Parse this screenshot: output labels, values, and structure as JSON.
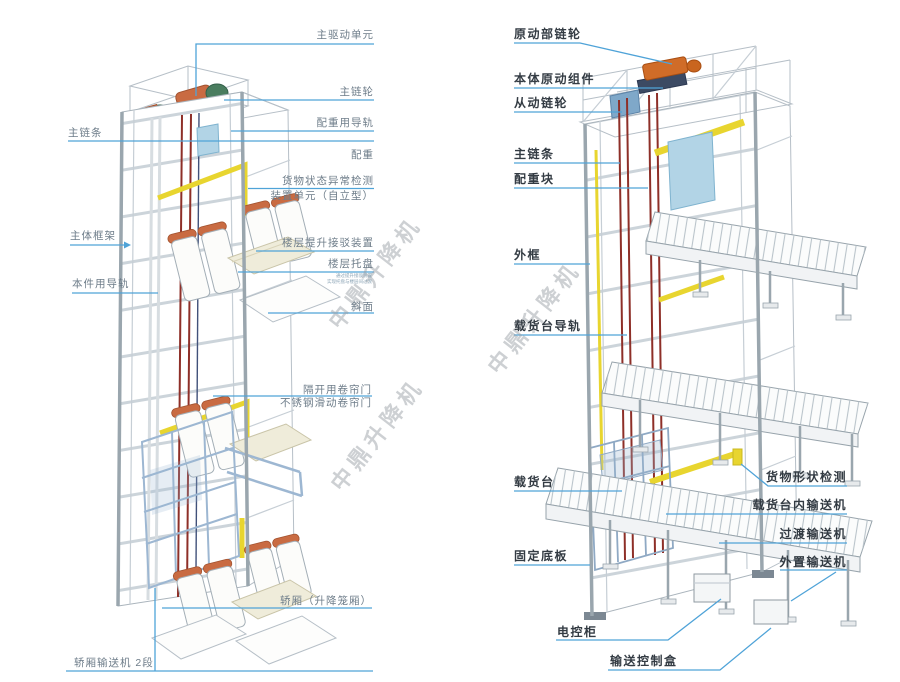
{
  "watermark": {
    "text": "中鼎升降机"
  },
  "left": {
    "labels": {
      "main_drive": "主驱动单元",
      "main_sprocket": "主链轮",
      "cw_guide_rail": "配重用导轨",
      "counterweight": "配重",
      "detect_line1": "货物状态异常检测",
      "detect_line2": "装置单元（自立型）",
      "main_chain": "主链条",
      "main_frame": "主体框架",
      "unit_guide_rail": "本件用导轨",
      "floor_docking": "楼层提升接驳装置",
      "floor_tray": "楼层托盘",
      "tray_note1": "通过提升接驳装置",
      "tray_note2": "实现托盘与楼层间过渡",
      "slope": "斜面",
      "roller_door": "隔开用卷帘门",
      "ss_door": "不锈钢滑动卷帘门",
      "cage": "轿厢（升降笼厢）",
      "cage_conveyor": "轿厢输送机 2段"
    }
  },
  "right": {
    "labels": {
      "drive_sprocket": "原动部链轮",
      "drive_assembly": "本体原动组件",
      "driven_sprocket": "从动链轮",
      "main_chain": "主链条",
      "cw_block": "配重块",
      "outer_frame": "外框",
      "platform_rail": "载货台导轨",
      "platform": "载货台",
      "base_plate": "固定底板",
      "control_cabinet": "电控柜",
      "conveyor_control_box": "输送控制盒",
      "shape_detect": "货物形状检测",
      "platform_conveyor": "载货台内输送机",
      "transition_conveyor": "过渡输送机",
      "external_conveyor": "外置输送机"
    }
  },
  "colors": {
    "leader_line": "#4fa3d8",
    "left_label": "#6d7c89",
    "right_label": "#333b43",
    "yellow_accent": "#e8d52f",
    "orange_part": "#c96b42",
    "chain_maroon": "#8e2f28",
    "blue_panel": "#b2d4e6",
    "cage_blue": "#9db7d2",
    "frame_line": "#b6bfc7"
  }
}
